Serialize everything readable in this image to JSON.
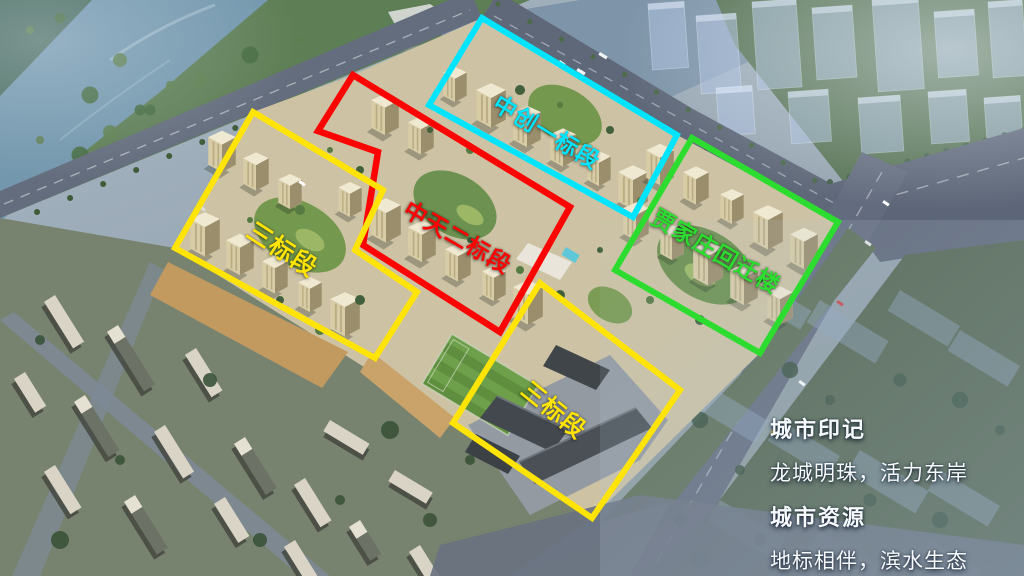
{
  "annotations": {
    "zhongchuang_section1": {
      "label": "中创一标段",
      "color": "#00e5ff"
    },
    "zhongtian_section2": {
      "label": "中天二标段",
      "color": "#fc0404"
    },
    "section3_west": {
      "label": "三标段",
      "color": "#ffe405"
    },
    "jiajiazhuang_resettle": {
      "label": "贾家庄回迁楼",
      "color": "#2cdd2f"
    },
    "section3_school": {
      "label": "三标段",
      "color": "#ffe405"
    }
  },
  "caption": {
    "heading1": "城市印记",
    "line1": "龙城明珠，活力东岸",
    "heading2": "城市资源",
    "line2": "地标相伴，滨水生态"
  }
}
